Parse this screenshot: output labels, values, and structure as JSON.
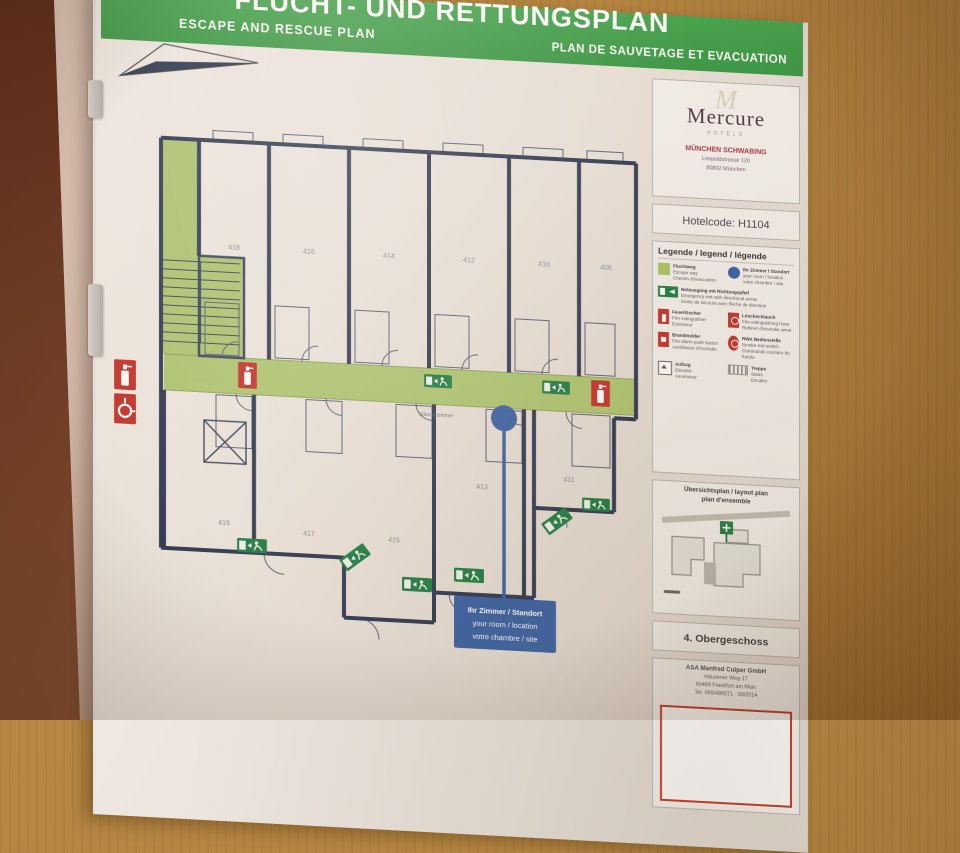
{
  "palette": {
    "banner_green": "#3fa24c",
    "route_green": "#a8c568",
    "exit_green": "#1e7f45",
    "alarm_red": "#c5342e",
    "location_blue": "#3a63a8",
    "wall_navy": "#2f3a54",
    "wood_brown": "#b2823f",
    "brand_plum": "#52384e",
    "accent_maroon": "#a63b4a"
  },
  "banner": {
    "title_de": "FLUCHT- UND RETTUNGSPLAN",
    "title_en": "ESCAPE AND RESCUE PLAN",
    "title_fr": "PLAN DE SAUVETAGE ET EVACUATION"
  },
  "hotel": {
    "brand": "Mercure",
    "brand_sub": "HOTELS",
    "name": "MÜNCHEN SCHWABING",
    "address1": "Leopoldstrasse 120",
    "address2": "80802 München",
    "hotelcode": "Hotelcode: H1104"
  },
  "legend": {
    "title": "Legende / legend / légende",
    "items": [
      {
        "icon": "escape-route-swatch",
        "de": "Fluchtweg",
        "en": "Escape way",
        "fr": "Chemin d'évacuation"
      },
      {
        "icon": "location-dot",
        "de": "Ihr Zimmer / Standort",
        "en": "your room / location",
        "fr": "votre chambre / site"
      },
      {
        "icon": "emergency-exit-sign",
        "de": "Notausgang mit Richtungspfeil",
        "en": "Emergency exit with directional arrow",
        "fr": "Sortie de secours avec flèche de direction"
      },
      {
        "icon": "fire-extinguisher",
        "de": "Feuerlöscher",
        "en": "Fire extinguisher",
        "fr": "Extincteur"
      },
      {
        "icon": "fire-hose",
        "de": "Löschschlauch",
        "en": "Fire extinguishing hose",
        "fr": "Robinet d'incendie armé"
      },
      {
        "icon": "fire-alarm",
        "de": "Brandmelder",
        "en": "Fire alarm push button",
        "fr": "Avertisseur d'incendie"
      },
      {
        "icon": "smoke-vent-switch",
        "de": "RWA Bedienstelle",
        "en": "Smoke exit switch",
        "fr": "Commande exutoire de fumée"
      },
      {
        "icon": "elevator",
        "de": "Aufzug",
        "en": "Elevator",
        "fr": "Ascenseur"
      },
      {
        "icon": "stairs",
        "de": "Treppe",
        "en": "Stairs",
        "fr": "Escalier"
      }
    ]
  },
  "overview": {
    "title1": "Übersichtsplan / layout plan",
    "title2": "plan d'ensemble"
  },
  "floor_label": "4. Obergeschoss",
  "publisher": {
    "company": "ASA Manfred Culper GmbH",
    "street": "Häusener Weg 17",
    "city": "60489 Frankfurt am Main",
    "phone": "Tel. 069/490071 · 09/2014"
  },
  "plan": {
    "rooms_top": [
      "418",
      "416",
      "414",
      "412",
      "410",
      "408"
    ],
    "rooms_bottom": [
      "419",
      "417",
      "415",
      "413",
      "411"
    ],
    "laundry": "Wäschezimmer",
    "callout": {
      "line1": "Ihr Zimmer / Standort",
      "line2": "your room / location",
      "line3": "votre chambre / site"
    }
  }
}
